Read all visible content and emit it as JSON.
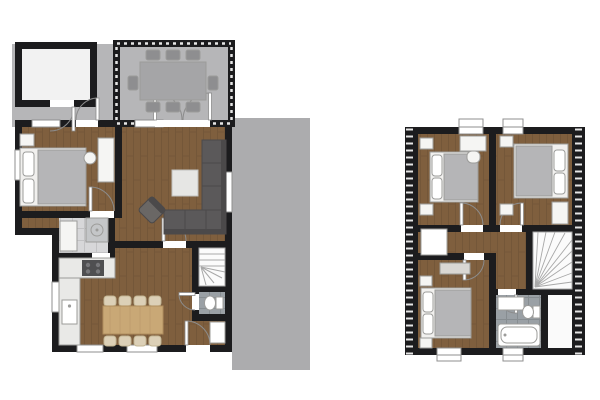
{
  "canvas": {
    "width": 600,
    "height": 400,
    "background": "#ffffff"
  },
  "drawing": {
    "kind": "architectural-floor-plan",
    "views": [
      {
        "id": "ground-floor",
        "rooms": [
          "shed",
          "patio",
          "conservatory",
          "bedroom",
          "living-room",
          "bathroom",
          "kitchen-dining",
          "hallway",
          "wc",
          "staircase",
          "terrace"
        ],
        "furniture": [
          "double-bed",
          "nightstand",
          "desk",
          "desk-chair",
          "corner-sofa",
          "armchair",
          "coffee-table",
          "shower",
          "bathtub",
          "kitchen-counter",
          "stove",
          "kitchen-sink",
          "dining-table",
          "dining-chairs-x8",
          "garden-table",
          "garden-chairs-x8",
          "toilet",
          "hall-closet"
        ]
      },
      {
        "id": "upper-floor",
        "rooms": [
          "bedroom-left",
          "bedroom-right",
          "bedroom-bottom",
          "landing",
          "bathroom",
          "staircase",
          "under-roof-storage"
        ],
        "furniture": [
          "double-bed-x3",
          "nightstand-x6",
          "desk",
          "desk-chair",
          "wardrobe",
          "dresser",
          "landing-closet",
          "vanity-sink",
          "toilet",
          "bathtub"
        ]
      }
    ]
  },
  "colors": {
    "background": "#ffffff",
    "wall": "#1c1c1e",
    "wall_hatch": "#e6e6e6",
    "wood_base": "#7f5f3e",
    "wood_grain": "#6b5034",
    "patio": "#b6b6b8",
    "terrace": "#acacae",
    "tile_light": "#d7d7d9",
    "tile_light_grid": "#c2c2c4",
    "tile_dark": "#9aa0a5",
    "tile_dark_grid": "#878d91",
    "white_fixture": "#f5f5f3",
    "fixture_outline": "#9c9c9a",
    "shed_floor": "#f2f2f2",
    "sofa": "#5b595a",
    "sofa_shadow": "#4b494a",
    "armchair": "#6a6765",
    "duvet": "#b5b5b7",
    "bed_frame": "#f1f0ee",
    "table_gray": "#a5a5a7",
    "chair_gray": "#8e8e90",
    "wood_table": "#c9a876",
    "wood_table_edge": "#b08e5e",
    "chair_beige": "#dcd0b7",
    "chair_beige_edge": "#c3b694",
    "counter": "#e9e9e7",
    "stove": "#4f4f51",
    "stair_fill": "#fbfbfb",
    "stair_tread": "#a8a8a8",
    "door": "#8c8c8c",
    "window_frame": "#8f8f8f",
    "dresser": "#d9d7d3"
  }
}
